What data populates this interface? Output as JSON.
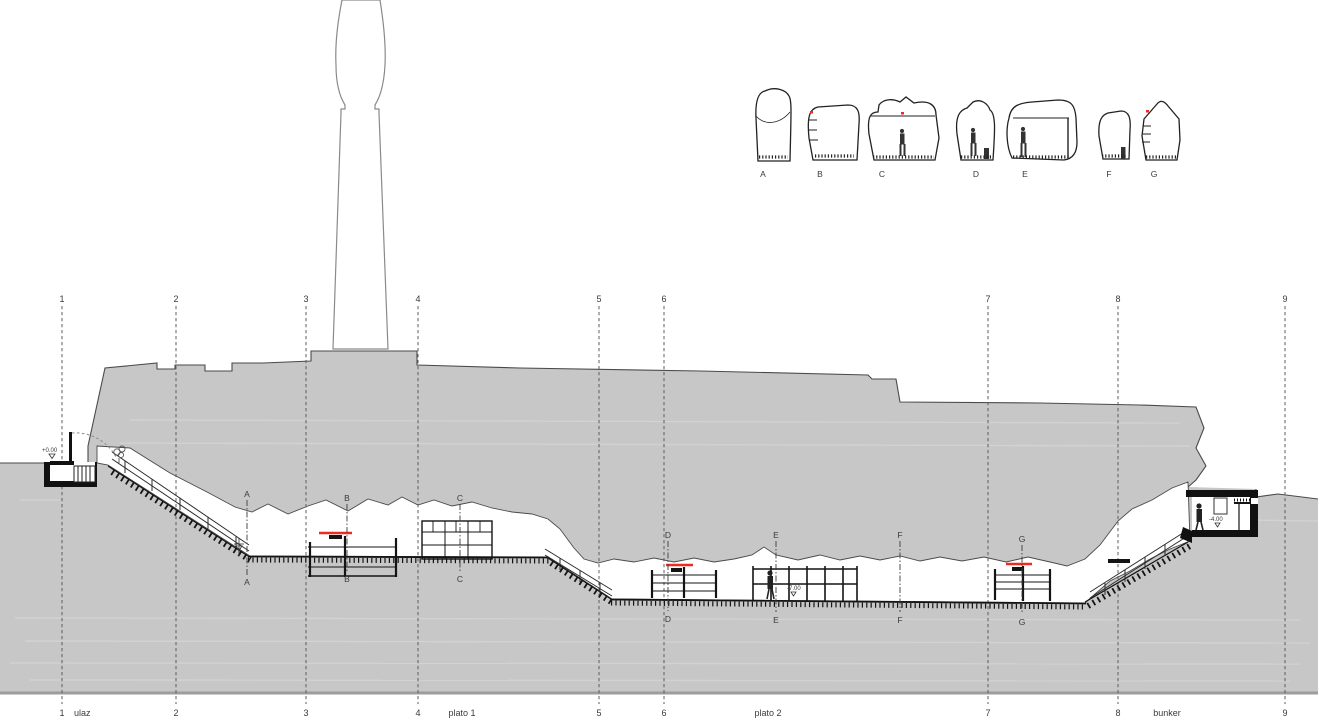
{
  "grid": {
    "numbers": [
      "1",
      "2",
      "3",
      "4",
      "5",
      "6",
      "7",
      "8",
      "9"
    ]
  },
  "zones": {
    "ulaz": "ulaz",
    "plato1": "plato 1",
    "plato2": "plato 2",
    "bunker": "bunker"
  },
  "legend": {
    "labels": [
      "A",
      "B",
      "C",
      "D",
      "E",
      "F",
      "G"
    ]
  },
  "marks": {
    "letters": [
      "A",
      "B",
      "C",
      "D",
      "E",
      "F",
      "G"
    ]
  },
  "levels": {
    "entrance": "+0.00",
    "plato2": "-7.00",
    "bunker": "-4.00"
  },
  "colors": {
    "terrain": "#c7c7c7",
    "red": "#ee2b23",
    "ink": "#1a1a1a",
    "edge": "#4a4a4a"
  }
}
